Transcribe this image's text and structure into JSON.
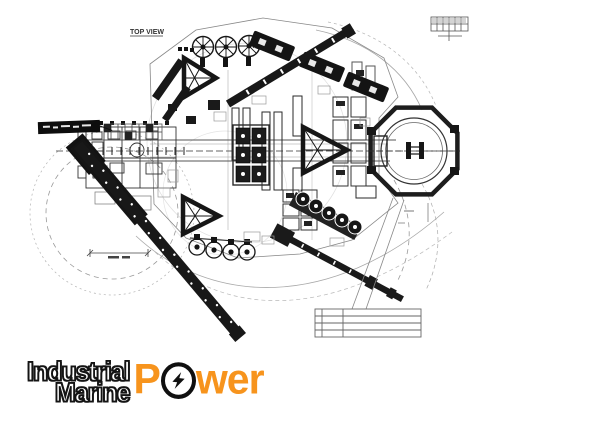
{
  "drawing": {
    "top_view_label": "TOP VIEW"
  },
  "logo": {
    "line1": "Industrial",
    "line2": "Marine",
    "power_first_letter": "P",
    "power_rest": "wer",
    "power_word": "Power",
    "orange": "#F7941D",
    "outline": "#141414",
    "icons": {
      "o_symbol": "lightning-bolt-icon"
    }
  },
  "colors": {
    "ink": "#1a1a1a",
    "medium_line": "#444444",
    "faint_line": "#aaaaaa",
    "background": "#ffffff"
  }
}
